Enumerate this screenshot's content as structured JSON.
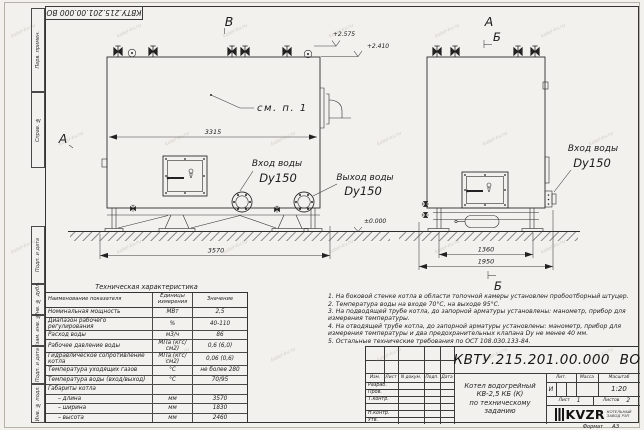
{
  "sheet": {
    "code_stamp": "КВТУ.215.201.00.000 ВО",
    "watermark": "kotel-kv.ru",
    "format_label": "Формат",
    "format_value": "А3",
    "margin_labels": [
      "Перв. примен.",
      "Справ. №",
      "Подп. и дата",
      "Инв. № дубл.",
      "Взам. инв. №",
      "Подп. и дата",
      "Инв. № подл."
    ]
  },
  "drawing": {
    "view_labels": {
      "front_top": "В",
      "front_left": "А",
      "side_top": "А",
      "side_section_top": "Б",
      "side_section_bottom": "Б"
    },
    "callout": "см. п. 1",
    "elevations": {
      "e1": "+2.575",
      "e2": "+2.410",
      "e0": "±0.000"
    },
    "dimensions": {
      "front_inner": "3315",
      "front_overall": "3570",
      "side_inner": "1360",
      "side_overall": "1950"
    },
    "ports": {
      "inlet_front_line1": "Вход воды",
      "inlet_front_line2": "Dy150",
      "outlet_front_line1": "Выход воды",
      "outlet_front_line2": "Dy150",
      "inlet_side_line1": "Вход воды",
      "inlet_side_line2": "Dy150"
    }
  },
  "spec_table": {
    "title": "Техническая характеристика",
    "headers": [
      "Наименование показателя",
      "Единицы измерения",
      "Значение"
    ],
    "rows": [
      [
        "Номинальная мощность",
        "МВт",
        "2,5"
      ],
      [
        "Диапазон рабочего регулирования",
        "%",
        "40-110"
      ],
      [
        "Расход воды",
        "м3/ч",
        "86"
      ],
      [
        "Рабочее давление воды",
        "МПа (кгс/см2)",
        "0,6 (6,0)"
      ],
      [
        "Гидравлическое сопротивление котла",
        "МПа (кгс/см2)",
        "0,06 (0,6)"
      ],
      [
        "Температура уходящих газов",
        "°С",
        "не более 280"
      ],
      [
        "Температура воды (вход/выход)",
        "°С",
        "70/95"
      ],
      [
        "Габариты котла",
        "",
        ""
      ],
      [
        "– длина",
        "мм",
        "3570"
      ],
      [
        "– ширина",
        "мм",
        "1830"
      ],
      [
        "– высота",
        "мм",
        "2460"
      ]
    ]
  },
  "notes": [
    "1.  На боковой стенке котла в области топочной камеры установлен пробоотборный штуцер.",
    "2.  Температура воды на входе 70°С, на выходе 95°С.",
    "3.  На подводящей трубе котла, до запорной арматуры установлены: манометр, прибор для измерения температуры.",
    "4.  На отводящей трубе котла, до запорной арматуры установлены: манометр, прибор для измерения температуры и два предохранительных клапана Dy не менее 40 мм.",
    "5.  Остальные технические требования по ОСТ 108.030.133-84."
  ],
  "title_block": {
    "doc_number": "КВТУ.215.201.00.000  ВО",
    "rev_header": [
      "Изм.",
      "Лист",
      "N докум.",
      "Подп.",
      "Дата"
    ],
    "row_labels": [
      "Разраб.",
      "Пров.",
      "Т.контр.",
      "",
      "Н.контр.",
      "Утв."
    ],
    "title_line1": "Котел водогрейный",
    "title_line2": "КВ-2,5 КБ (К)",
    "title_line3": "по техническому заданию",
    "lit_header": "Лит.",
    "mass_header": "Масса",
    "scale_header": "Масштаб",
    "lit_value": "И",
    "scale_value": "1:20",
    "sheet_label": "Лист",
    "sheet_value": "1",
    "sheets_label": "Листов",
    "sheets_value": "2",
    "logo_text": "KVZR",
    "company_line1": "КОТЕЛЬНЫЙ",
    "company_line2": "ЗАВОД РЭП"
  }
}
